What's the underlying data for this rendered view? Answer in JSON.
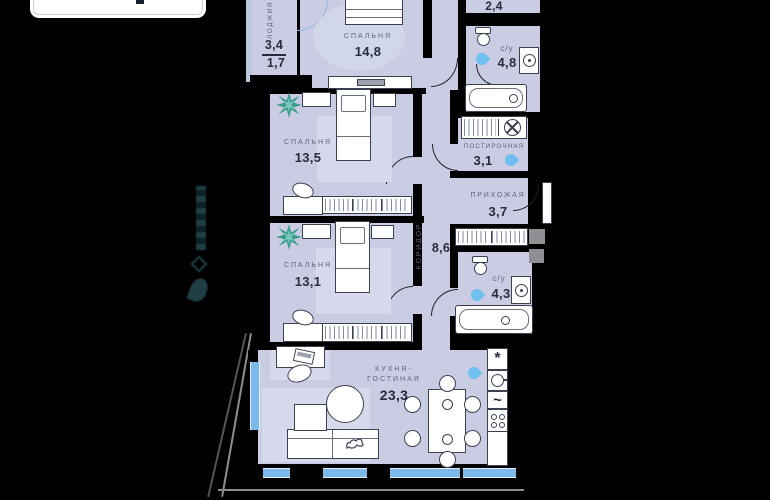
{
  "colors": {
    "floor": "#c9cce2",
    "rug": "#d6d9ec",
    "wall": "#000000",
    "window": "#7cb9e9",
    "water": "#6fc0ee",
    "plant": "#3b9d8d",
    "line": "#3c4150",
    "text_muted": "#60657c",
    "text_dark": "#272c3f"
  },
  "icons": {
    "fridge": "*",
    "dishwasher": "~"
  },
  "rooms": {
    "loggia": {
      "name": "ЛОДЖИЯ",
      "area": "3,4",
      "area_secondary": "1,7"
    },
    "bedroom_master": {
      "name": "СПАЛЬНЯ",
      "area": "14,8"
    },
    "bedroom_2": {
      "name": "СПАЛЬНЯ",
      "area": "13,5"
    },
    "bedroom_3": {
      "name": "СПАЛЬНЯ",
      "area": "13,1"
    },
    "wardrobe": {
      "area": "2,4"
    },
    "bathroom_1": {
      "name": "с/у",
      "area": "4,8"
    },
    "laundry": {
      "name": "ПОСТИРОЧНАЯ",
      "area": "3,1"
    },
    "hallway": {
      "name": "ПРИХОЖАЯ",
      "area": "3,7"
    },
    "corridor": {
      "name": "КОРИДОР",
      "area": "8,6"
    },
    "bathroom_2": {
      "name": "с/у",
      "area": "4,3"
    },
    "kitchen_living": {
      "name_line1": "КУХНЯ-",
      "name_line2": "ГОСТИНАЯ",
      "area": "23,3"
    }
  }
}
